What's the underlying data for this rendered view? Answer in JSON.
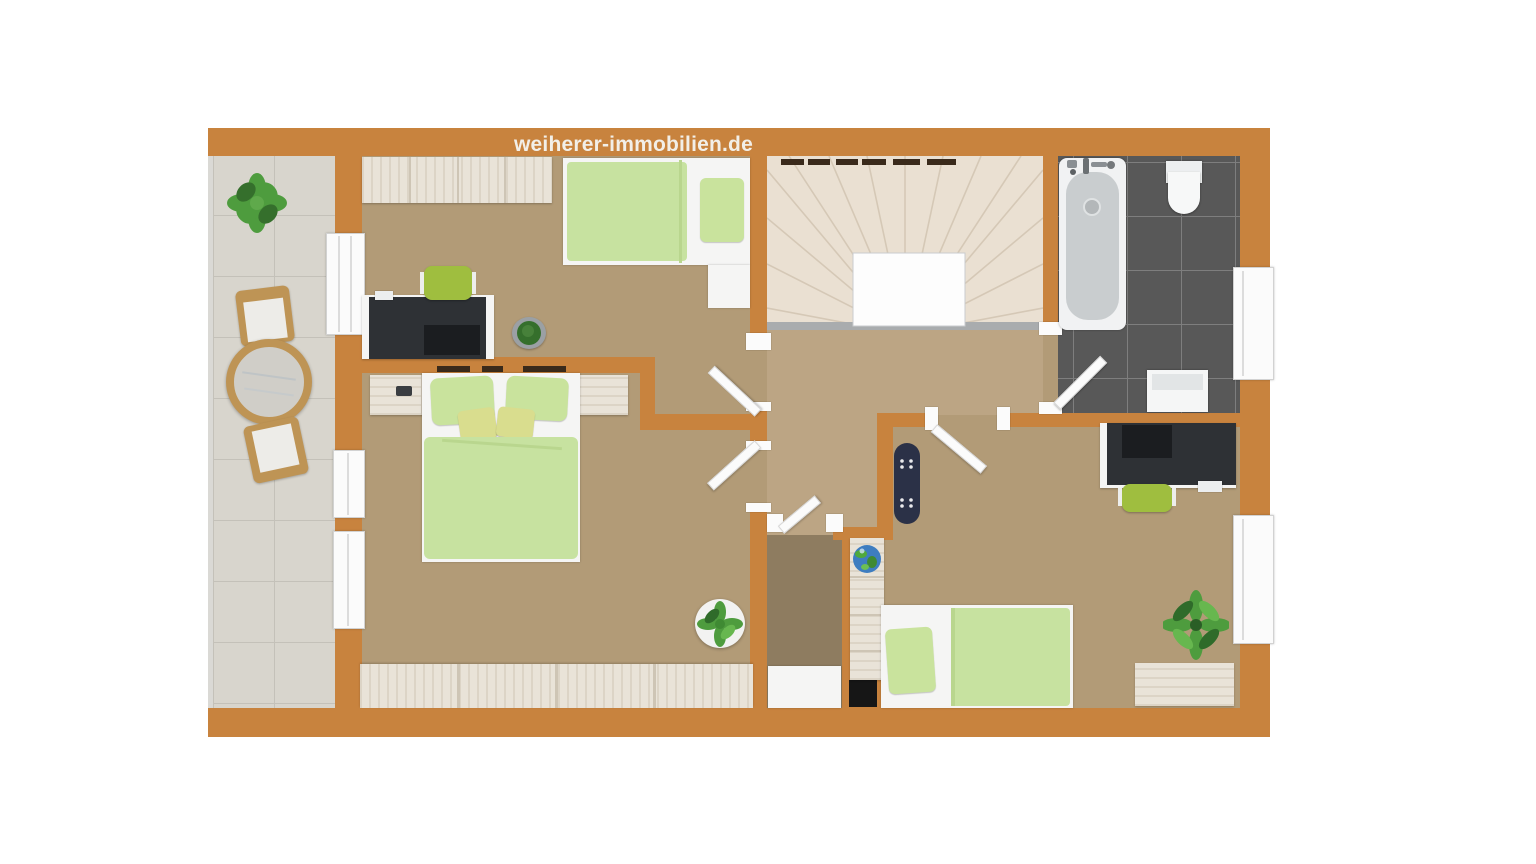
{
  "watermark": {
    "text": "weiherer-immobilien.de"
  },
  "colors": {
    "wall": "#C8833E",
    "floor_room": "#B29B77",
    "floor_hall": "#BCA584",
    "floor_closet": "#8E7C60",
    "balcony_tile": "#D8D5CD",
    "balcony_grout": "#C4C1B9",
    "stairs_bg": "#EAE0D2",
    "stairs_line": "#D5C8B6",
    "landing_white": "#FDFDFD",
    "stringer": "#A9ACAE",
    "bath_tile": "#585858",
    "bath_grout": "#7E7E7E",
    "wood": "#E9E3D8",
    "wood_seam": "#CEC5B5",
    "white_furniture": "#F5F5F4",
    "green_duvet": "#C7E2A0",
    "green_pillow": "#C9E39D",
    "yellow_pillow": "#D9DD8E",
    "green_chair": "#9FBE3F",
    "desk_dark": "#2E3135",
    "laptop_dark": "#1B1D20",
    "skateboard_navy": "#2B3147",
    "rattan": "#BE9455",
    "glass": "#D0CEC8",
    "plant": "#4E9C3E",
    "plant_dark": "#356F2C",
    "pot_gray": "#9BA0A4",
    "pot_white": "#F2F2F1",
    "globe_blue": "#3E7DC0",
    "chimney": "#161616",
    "frame_white": "#FBFBFB",
    "watermark_text": "#F2EFE8",
    "tub_inner": "#C9CDCF",
    "dark_dash": "#3A2A1B"
  }
}
